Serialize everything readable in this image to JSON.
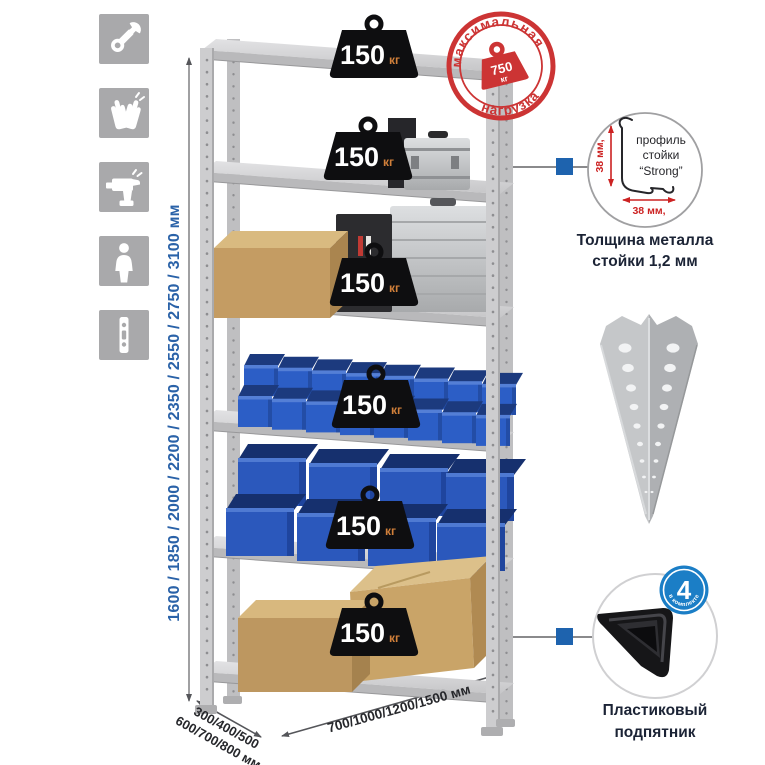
{
  "palette": {
    "stamp_red": "#cc3434",
    "dimension_blue": "#2a62a8",
    "bin_blue": "#2c5ec6",
    "badge_blue": "#1b7ec6",
    "weight_unit_orange": "#d07f3a",
    "icon_tile_gray": "#a9a9ab"
  },
  "left_toolbar": {
    "icons": [
      "wrench-icon",
      "gloves-icon",
      "drill-icon",
      "person-icon",
      "rack-post-icon"
    ]
  },
  "rack": {
    "shelf_count": 6,
    "shelf_loads": [
      {
        "value": "150",
        "unit": "кг"
      },
      {
        "value": "150",
        "unit": "кг"
      },
      {
        "value": "150",
        "unit": "кг"
      },
      {
        "value": "150",
        "unit": "кг"
      },
      {
        "value": "150",
        "unit": "кг"
      },
      {
        "value": "150",
        "unit": "кг"
      }
    ]
  },
  "max_load_stamp": {
    "arc_top": "максимальная",
    "arc_bottom": "нагрузка",
    "value": "750",
    "unit": "кг"
  },
  "dimensions": {
    "height": "1600 / 1850 / 2000 / 2200 / 2350 / 2550 / 2750 / 3100 мм",
    "depth_line1": "300/400/500",
    "depth_line2": "600/700/800 мм",
    "width": "700/1000/1200/1500 мм"
  },
  "profile_detail": {
    "label_line1": "профиль",
    "label_line2": "стойки",
    "label_line3": "“Strong”",
    "dim_vertical": "38 мм,",
    "dim_horizontal": "38 мм,",
    "caption_line1": "Толщина металла",
    "caption_line2": "стойки 1,2 мм"
  },
  "foot_detail": {
    "badge_value": "4",
    "badge_label": "в комплекте",
    "caption_line1": "Пластиковый",
    "caption_line2": "подпятник"
  }
}
